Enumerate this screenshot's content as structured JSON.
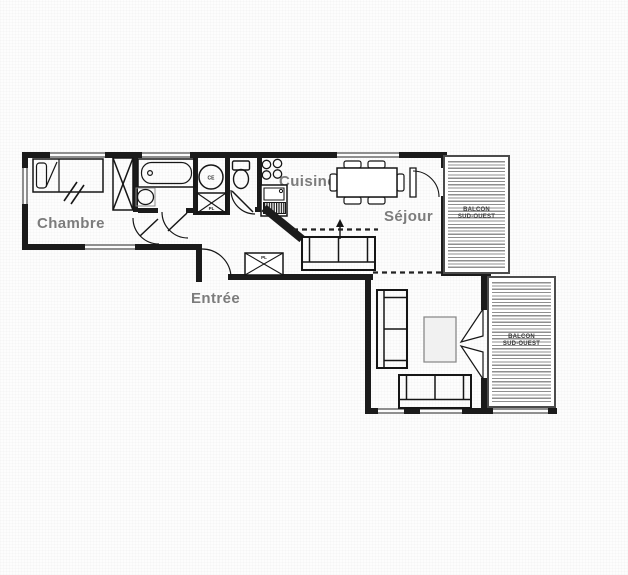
{
  "labels": {
    "chambre": "Chambre",
    "cuisine": "Cuisine",
    "sejour": "Séjour",
    "entree": "Entrée"
  },
  "balcony_upper": {
    "line1": "BALCON",
    "line2": "SUD-OUEST"
  },
  "balcony_lower": {
    "line1": "BALCON",
    "line2": "SUD-OUEST"
  },
  "symbols": {
    "washer_text": "CE",
    "closet_bath_label": "PL",
    "closet_entree_label": "PL"
  },
  "colors": {
    "wall": "#1b1b1b",
    "room_label": "#7c7c7c",
    "hatch_line": "#8f8f8f",
    "balcony_border": "#4c4c4c"
  }
}
